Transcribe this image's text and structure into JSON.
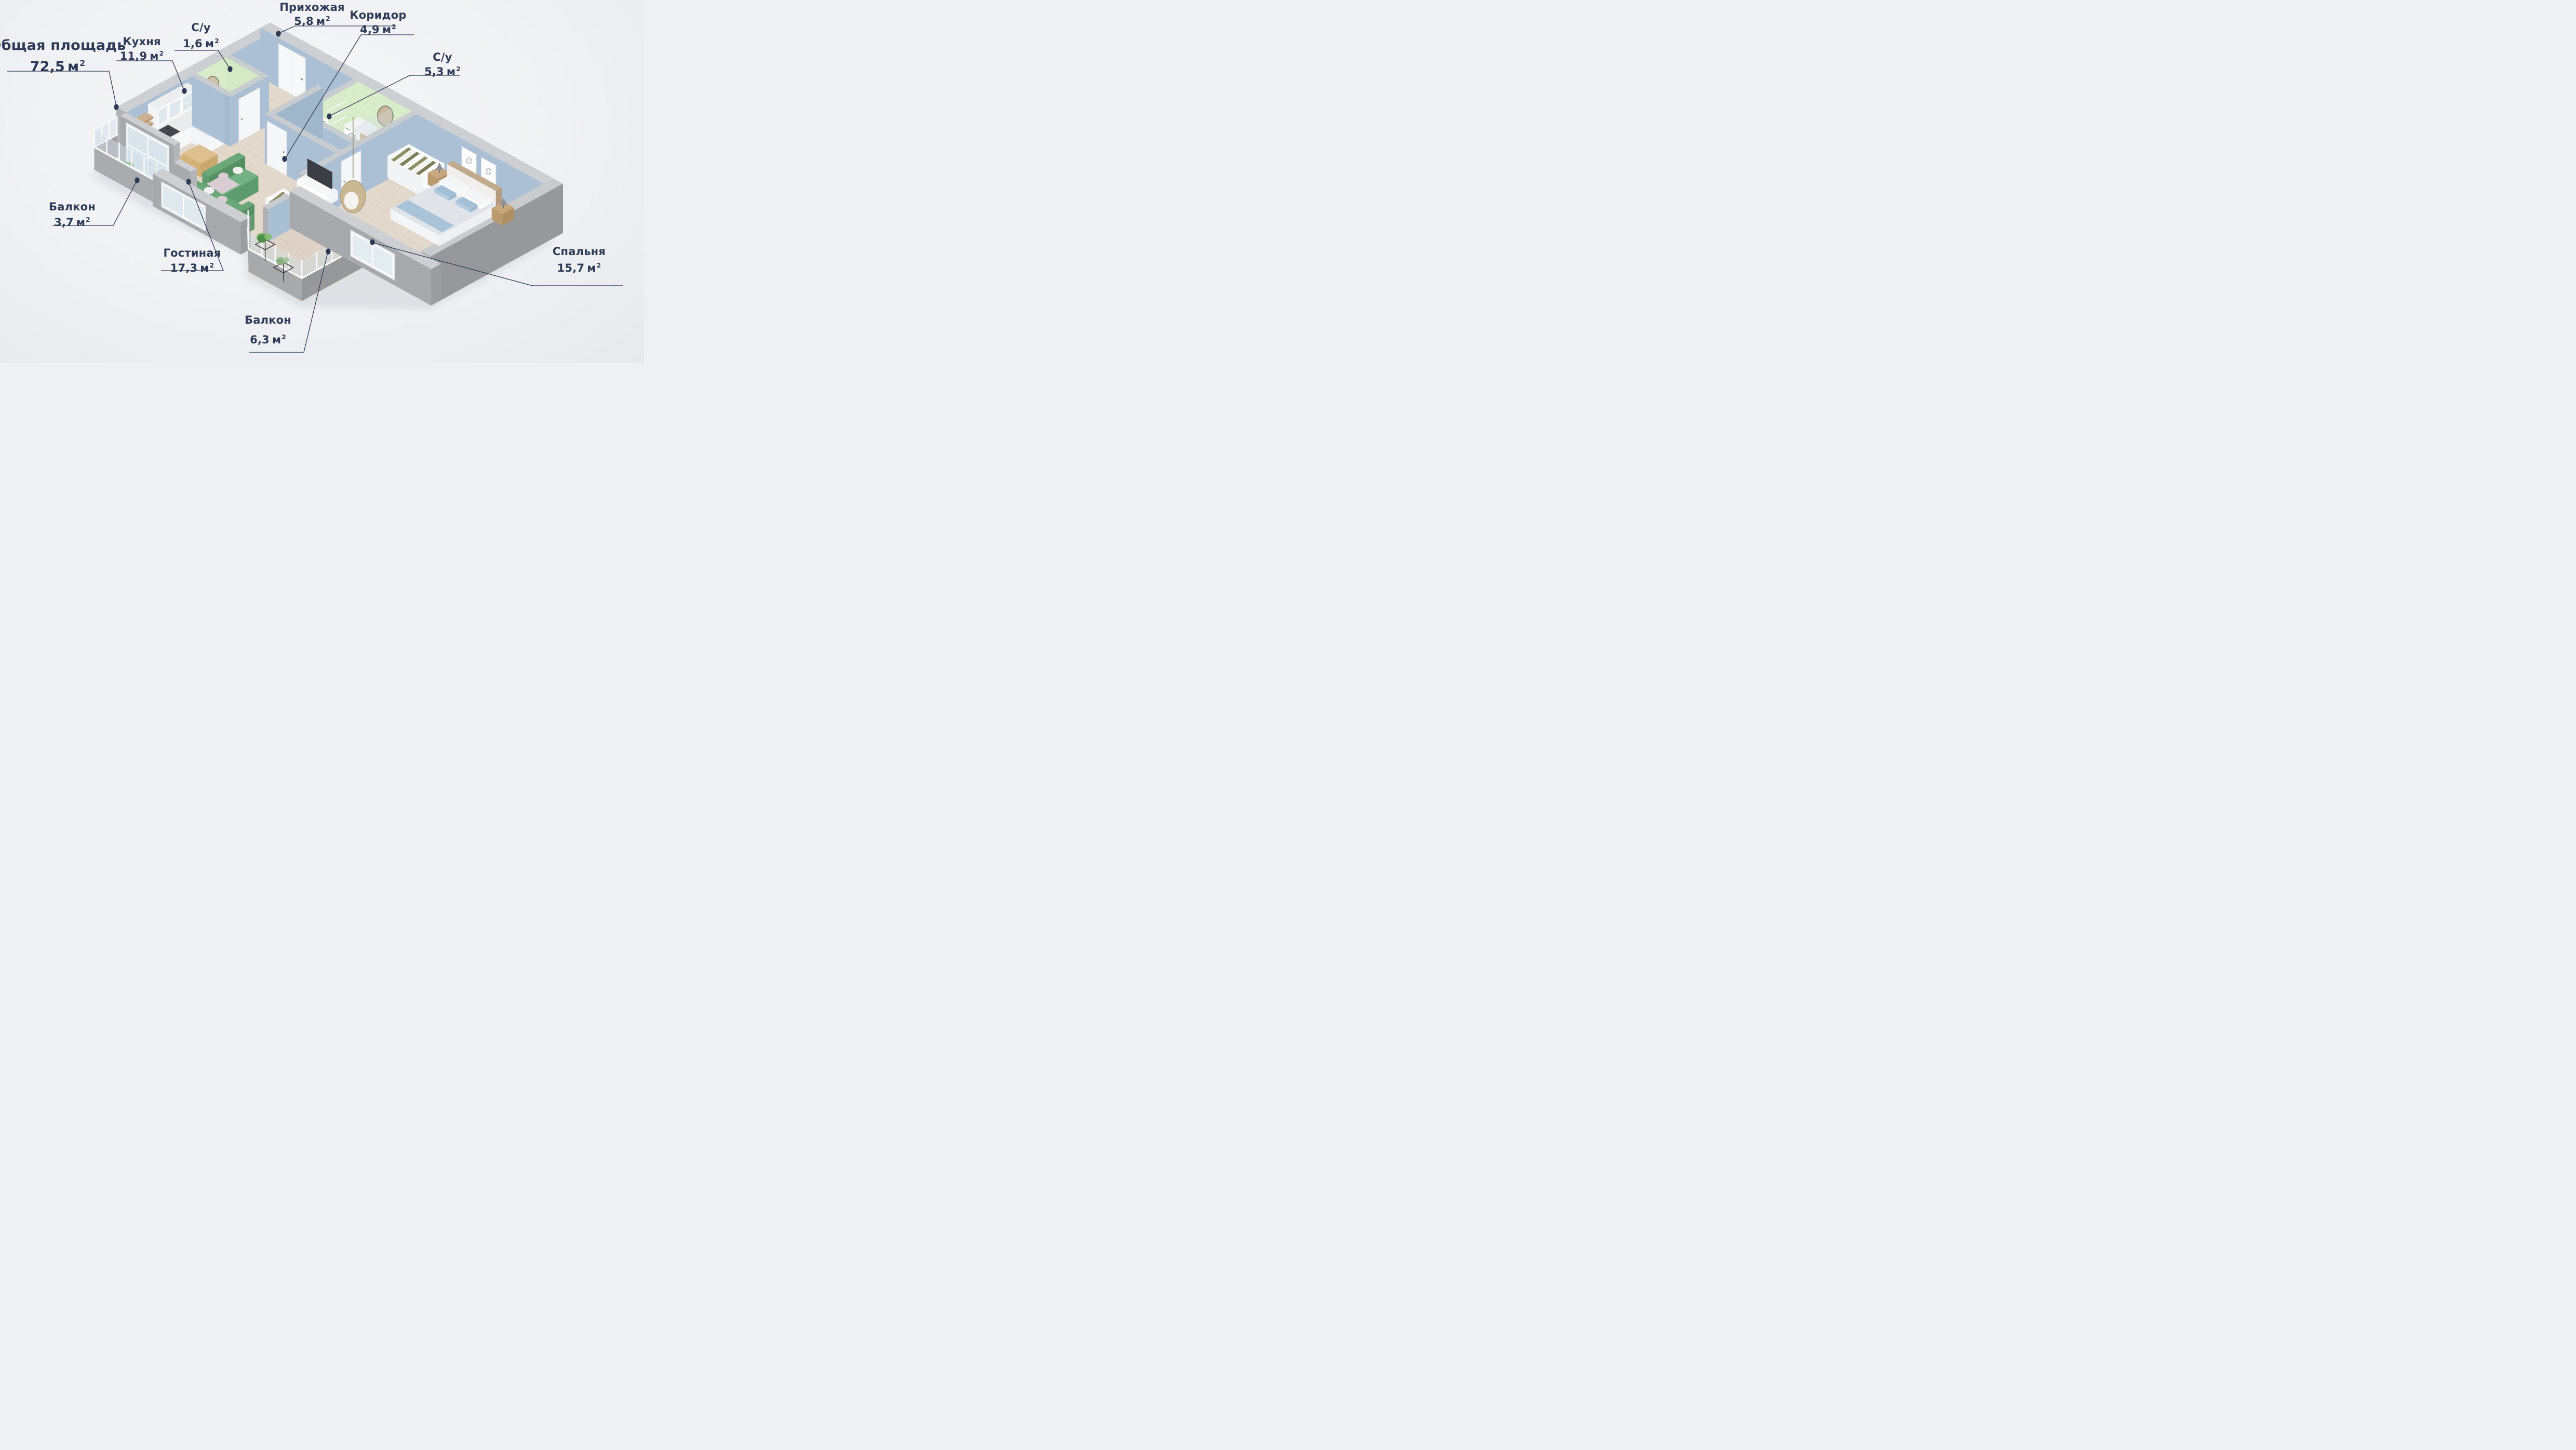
{
  "title": {
    "name": "Общая площадь",
    "area": "72,5",
    "unit": "м",
    "sup": "2"
  },
  "rooms": [
    {
      "id": "prihozhaya",
      "name": "Прихожая",
      "area": "5,8",
      "unit": "м",
      "sup": "2"
    },
    {
      "id": "su-1",
      "name": "С/у",
      "area": "1,6",
      "unit": "м",
      "sup": "2"
    },
    {
      "id": "kuhnya",
      "name": "Кухня",
      "area": "11,9",
      "unit": "м",
      "sup": "2"
    },
    {
      "id": "koridor",
      "name": "Коридор",
      "area": "4,9",
      "unit": "м",
      "sup": "2"
    },
    {
      "id": "su-2",
      "name": "С/у",
      "area": "5,3",
      "unit": "м",
      "sup": "2"
    },
    {
      "id": "balkon-1",
      "name": "Балкон",
      "area": "3,7",
      "unit": "м",
      "sup": "2"
    },
    {
      "id": "gostinaya",
      "name": "Гостиная",
      "area": "17,3",
      "unit": "м",
      "sup": "2"
    },
    {
      "id": "balkon-2",
      "name": "Балкон",
      "area": "6,3",
      "unit": "м",
      "sup": "2"
    },
    {
      "id": "spalnya",
      "name": "Спальня",
      "area": "15,7",
      "unit": "м",
      "sup": "2"
    }
  ],
  "colors": {
    "accent": "#2e3a55",
    "background": "#f1f2f4",
    "wall_top": "#cdcfd2",
    "wall_gray": "#a8a9ad",
    "wall_blue": "#abc0d4",
    "tile_green": "#d9ecc9",
    "floor_wood": "#e2d8cb",
    "sofa_green": "#6aa87a",
    "glass": "#d2dee6"
  }
}
